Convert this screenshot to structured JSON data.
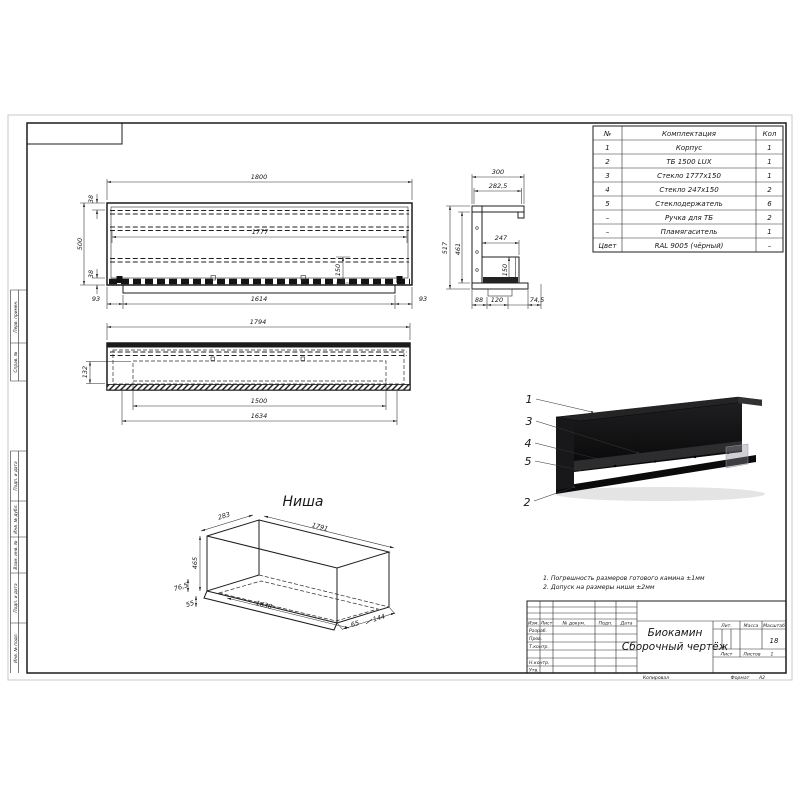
{
  "frame": {
    "left_labels": [
      "Перв. примен.",
      "Справ. №",
      "Подп. и дата",
      "Инв. № дубл.",
      "Взам. инв. №",
      "Подп. и дата",
      "Инв. № подл."
    ]
  },
  "parts_table": {
    "headers": {
      "num": "№",
      "name": "Комплектация",
      "qty": "Кол"
    },
    "rows": [
      {
        "num": "1",
        "name": "Корпус",
        "qty": "1"
      },
      {
        "num": "2",
        "name": "ТБ 1500 LUX",
        "qty": "1"
      },
      {
        "num": "3",
        "name": "Стекло 1777х150",
        "qty": "1"
      },
      {
        "num": "4",
        "name": "Стекло 247х150",
        "qty": "2"
      },
      {
        "num": "5",
        "name": "Стеклодержатель",
        "qty": "6"
      },
      {
        "num": "–",
        "name": "Ручка для ТБ",
        "qty": "2"
      },
      {
        "num": "–",
        "name": "Пламягаситель",
        "qty": "1"
      },
      {
        "num": "Цвет",
        "name": "RAL 9005 (чёрный)",
        "qty": "–"
      }
    ]
  },
  "front_view": {
    "dim_total_width": "1800",
    "dim_inner_width": "1777",
    "dim_total_height": "500",
    "dim_top_flange": "38",
    "dim_bottom_flange": "38",
    "dim_glass_height": "150",
    "dim_margin_left": "93",
    "dim_tray_length": "1614",
    "dim_margin_right": "93"
  },
  "side_view": {
    "dim_width": "300",
    "dim_inner_width": "282,5",
    "dim_height": "517",
    "dim_inner_height": "461",
    "dim_opening": "247",
    "dim_burner_height": "150",
    "dim_a": "88",
    "dim_b": "120",
    "dim_c": "74,5"
  },
  "top_view": {
    "dim_length": "1794",
    "dim_depth": "132",
    "dim_burner": "1500",
    "dim_opening": "1634"
  },
  "niche_view": {
    "title": "Ниша",
    "dim_depth": "283",
    "dim_length": "1791",
    "dim_height": "465",
    "dim_lip": "76,5",
    "dim_bottom_offset": "55",
    "dim_bottom_length": "1638",
    "dim_end_a": "65",
    "dim_end_b": "144"
  },
  "render_view": {
    "callouts": [
      "1",
      "3",
      "4",
      "5",
      "2"
    ]
  },
  "notes": {
    "line1": "1. Погрешность размеров готового камина ±1мм",
    "line2": "2. Допуск на размеры ниши ±2мм"
  },
  "title_block": {
    "cols": {
      "izm": "Изм.",
      "list": "Лист",
      "doc": "№ докум.",
      "podp": "Подп.",
      "data": "Дата"
    },
    "rows": {
      "razrab": "Разраб.",
      "prov": "Пров.",
      "tkontr": "Т.контр.",
      "nkontr": "Н.контр.",
      "utv": "Утв."
    },
    "doc_title1": "Биокамин",
    "doc_title2": "Сборочный чертёж",
    "lit": "Лит.",
    "mass": "Масса",
    "scale": "Масштаб",
    "scale_value": "18",
    "sheet": "Лист",
    "sheets": "Листов",
    "sheets_value": "1",
    "copied": "Копировал",
    "format": "Формат",
    "format_value": "А2"
  }
}
